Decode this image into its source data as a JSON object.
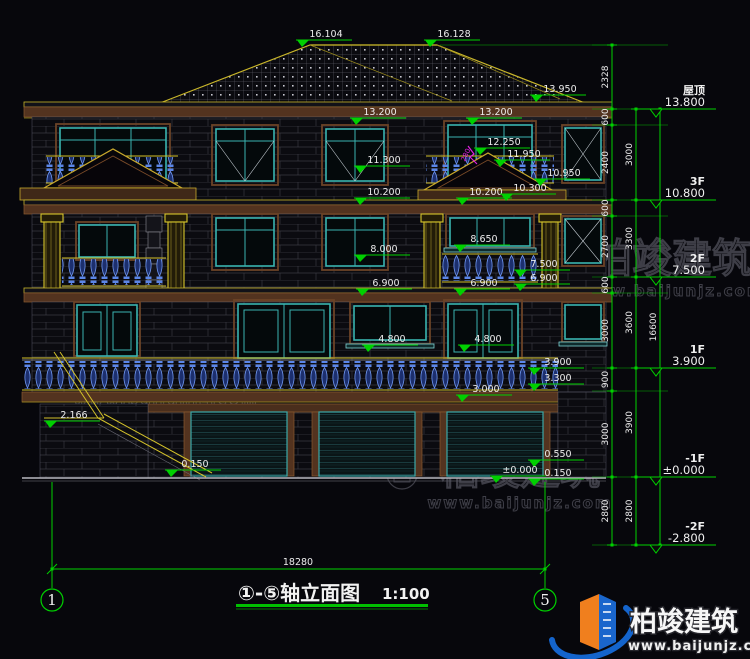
{
  "title": {
    "full": "①-⑤轴立面图",
    "scale": "1:100"
  },
  "bottom_dim": {
    "text": "18280"
  },
  "axis_bubbles": [
    {
      "n": "1",
      "x": 52
    },
    {
      "n": "5",
      "x": 545
    }
  ],
  "elevation_labels": [
    {
      "t": "16.104",
      "x": 302,
      "y": 47
    },
    {
      "t": "16.128",
      "x": 430,
      "y": 47
    },
    {
      "t": "13.950",
      "x": 536,
      "y": 102
    },
    {
      "t": "13.200",
      "x": 356,
      "y": 125
    },
    {
      "t": "13.200",
      "x": 472,
      "y": 125
    },
    {
      "t": "12.250",
      "x": 480,
      "y": 155
    },
    {
      "t": "11.950",
      "x": 500,
      "y": 167
    },
    {
      "t": "11.300",
      "x": 360,
      "y": 173
    },
    {
      "t": "10.950",
      "x": 540,
      "y": 186
    },
    {
      "t": "10.200",
      "x": 360,
      "y": 205
    },
    {
      "t": "10.200",
      "x": 462,
      "y": 205
    },
    {
      "t": "10.300",
      "x": 506,
      "y": 201
    },
    {
      "t": "8.650",
      "x": 460,
      "y": 252
    },
    {
      "t": "8.000",
      "x": 360,
      "y": 262
    },
    {
      "t": "7.500",
      "x": 520,
      "y": 277
    },
    {
      "t": "6.900",
      "x": 362,
      "y": 296
    },
    {
      "t": "6.900",
      "x": 460,
      "y": 296
    },
    {
      "t": "6.900",
      "x": 520,
      "y": 291
    },
    {
      "t": "4.800",
      "x": 368,
      "y": 352
    },
    {
      "t": "4.800",
      "x": 464,
      "y": 352
    },
    {
      "t": "3.900",
      "x": 534,
      "y": 375
    },
    {
      "t": "3.300",
      "x": 534,
      "y": 391
    },
    {
      "t": "3.000",
      "x": 462,
      "y": 402
    },
    {
      "t": "2.166",
      "x": 50,
      "y": 428
    },
    {
      "t": "0.550",
      "x": 534,
      "y": 467
    },
    {
      "t": "±0.000",
      "x": 496,
      "y": 483
    },
    {
      "t": "0.150",
      "x": 534,
      "y": 486
    },
    {
      "t": "0.150",
      "x": 171,
      "y": 477
    }
  ],
  "level_markers": [
    {
      "name": "屋顶",
      "elev": "13.800",
      "y": 109
    },
    {
      "name": "3F",
      "elev": "10.800",
      "y": 200
    },
    {
      "name": "2F",
      "elev": "7.500",
      "y": 277
    },
    {
      "name": "1F",
      "elev": "3.900",
      "y": 368
    },
    {
      "name": "-1F",
      "elev": "±0.000",
      "y": 477
    },
    {
      "name": "-2F",
      "elev": "-2.800",
      "y": 545
    }
  ],
  "dim_chains": [
    {
      "x": 612,
      "bounds": [
        45,
        109,
        125,
        200,
        216,
        277,
        293,
        368,
        391,
        477,
        545
      ],
      "labels": [
        "2328",
        "600",
        "2400",
        "600",
        "2700",
        "600",
        "3000",
        "900",
        "3000",
        "2800"
      ]
    },
    {
      "x": 636,
      "bounds": [
        109,
        200,
        277,
        368,
        477,
        545
      ],
      "labels": [
        "3000",
        "3300",
        "3600",
        "3900",
        "2800"
      ]
    },
    {
      "x": 660,
      "bounds": [
        109,
        545
      ],
      "labels": [
        "16600"
      ]
    }
  ],
  "annotations": [
    {
      "text": "280",
      "x": 465,
      "y": 162,
      "rot": -65
    }
  ],
  "watermark": {
    "brand": "柏竣建筑",
    "url": "www.baijunjz.com",
    "positions": [
      {
        "x": 258,
        "y": 168
      },
      {
        "x": 664,
        "y": 272
      },
      {
        "x": 158,
        "y": 380
      },
      {
        "x": 512,
        "y": 484
      }
    ]
  },
  "logo": {
    "brand": "柏竣建筑",
    "url": "www.baijunjz.com"
  },
  "colors": {
    "dim_green": "#00d000",
    "roof_yellow": "#d3c12a",
    "cornice_brown": "#53331f",
    "window_teal": "#3ab4b0",
    "baluster_blue": "#5b86e8",
    "logo_blue": "#1464cc",
    "logo_orange": "#f07f1e"
  }
}
